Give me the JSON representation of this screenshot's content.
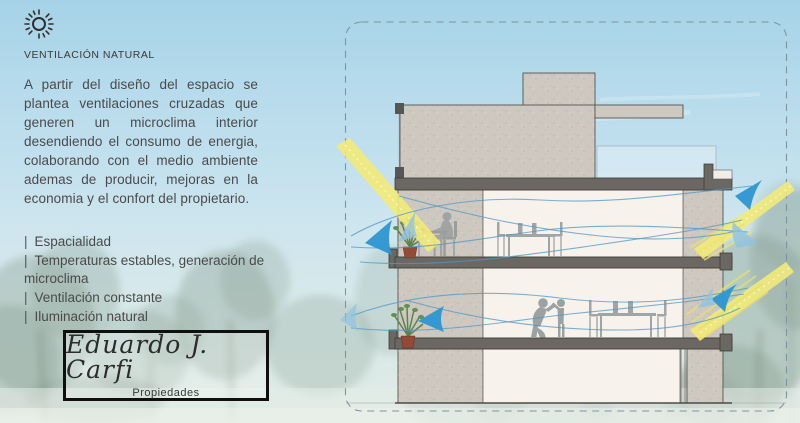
{
  "header": {
    "icon": "sun-icon",
    "title": "VENTILACIÓN NATURAL"
  },
  "intro": "A partir del diseño del espacio se plantea ventilaciones cruzadas que generen un microclima interior desendiendo el consumo de energia, colaborando con el medio ambiente ademas de producir, mejoras en la economia y el confort del propietario.",
  "features": [
    {
      "bullet": "|",
      "label": "Espacialidad"
    },
    {
      "bullet": "|",
      "label": "Temperaturas estables, generación de microclima"
    },
    {
      "bullet": "|",
      "label": "Ventilación constante"
    },
    {
      "bullet": "|",
      "label": "Iluminación natural"
    }
  ],
  "brand": {
    "name": "Eduardo J. Carfi",
    "tagline": "Propiedades"
  },
  "diagram": {
    "type": "architectural-cross-section",
    "floors": 3,
    "colors": {
      "sky_top": "#a6d2e7",
      "sky_bottom": "#dfeae5",
      "wall": "#cdc8c0",
      "slab": "#6b6763",
      "interior": "#f8f2ed",
      "airflow_blue": "#2d96d1",
      "airflow_light": "#8fc3e0",
      "stream_blue": "#4e98c6",
      "sunray_yellow": "#f2ea78",
      "tree_green": "#8ca396",
      "silhouette": "#8d9394",
      "frame_dash": "#7f94a1"
    }
  }
}
